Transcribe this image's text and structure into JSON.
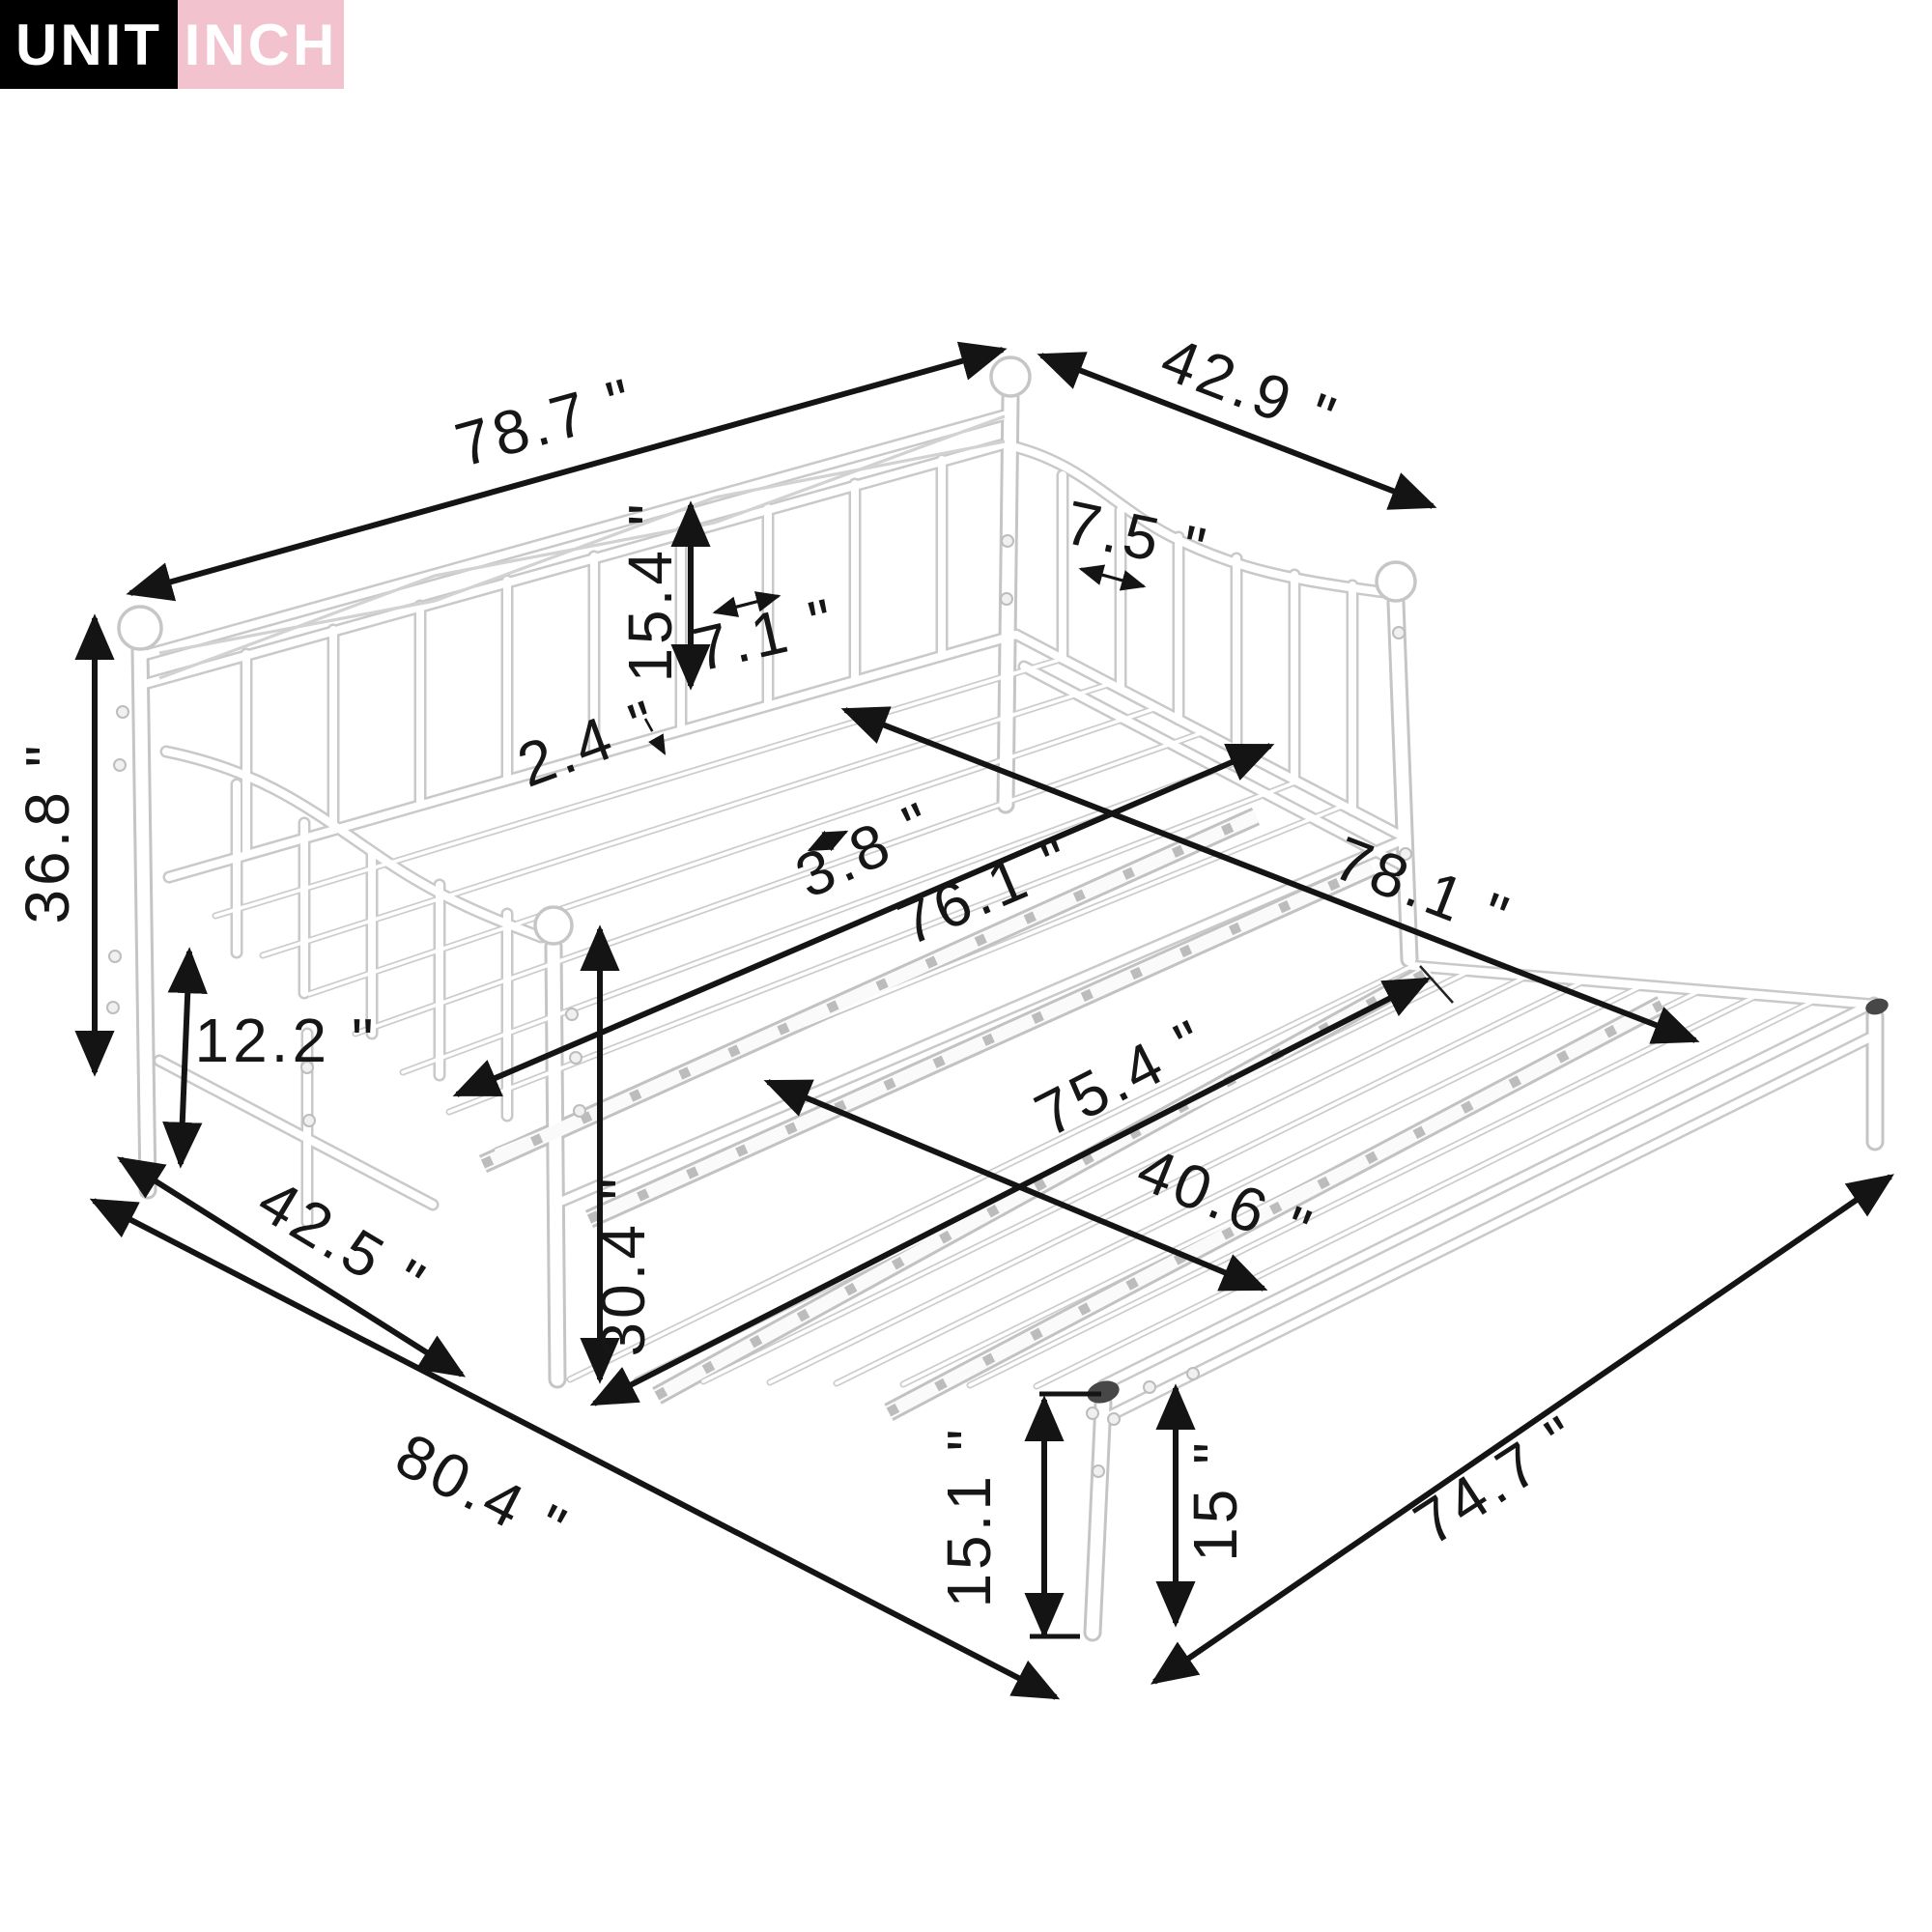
{
  "badge": {
    "unit_label": "UNIT",
    "unit_value": "INCH",
    "unit_bg": "#000000",
    "value_bg": "#f2c3ce",
    "text_color": "#ffffff"
  },
  "diagram": {
    "type": "product-dimension-diagram",
    "frame_color": "#c9c9c9",
    "dimension_color": "#141414",
    "leg_cap_color": "#474747",
    "dimensions": {
      "daybed_top_length": {
        "label": "78.7 \"",
        "value": 78.7
      },
      "daybed_top_width": {
        "label": "42.9 \"",
        "value": 42.9
      },
      "back_bar_spacing": {
        "label": "7.5 \"",
        "value": 7.5
      },
      "back_panel_height": {
        "label": "15.4 \"",
        "value": 15.4
      },
      "mid_bar_spacing": {
        "label": "7.1 \"",
        "value": 7.1
      },
      "tube_size": {
        "label": "2.4 \"",
        "value": 2.4
      },
      "slat_gap": {
        "label": "3.8 \"",
        "value": 3.8
      },
      "back_post_height": {
        "label": "36.8 \"",
        "value": 36.8
      },
      "platform_height": {
        "label": "12.2 \"",
        "value": 12.2
      },
      "daybed_bottom_width": {
        "label": "42.5 \"",
        "value": 42.5
      },
      "floor_length": {
        "label": "80.4 \"",
        "value": 80.4
      },
      "front_post_height": {
        "label": "30.4 \"",
        "value": 30.4
      },
      "daybed_sleep_length": {
        "label": "76.1 \"",
        "value": 76.1
      },
      "trundle_length": {
        "label": "78.1 \"",
        "value": 78.1
      },
      "trundle_sleep_length": {
        "label": "75.4 \"",
        "value": 75.4
      },
      "trundle_inner_width": {
        "label": "40.6 \"",
        "value": 40.6
      },
      "trundle_leg_height_a": {
        "label": "15.1 \"",
        "value": 15.1
      },
      "trundle_leg_height_b": {
        "label": "15 \"",
        "value": 15
      },
      "trundle_side_length": {
        "label": "74.7 \"",
        "value": 74.7
      }
    }
  }
}
